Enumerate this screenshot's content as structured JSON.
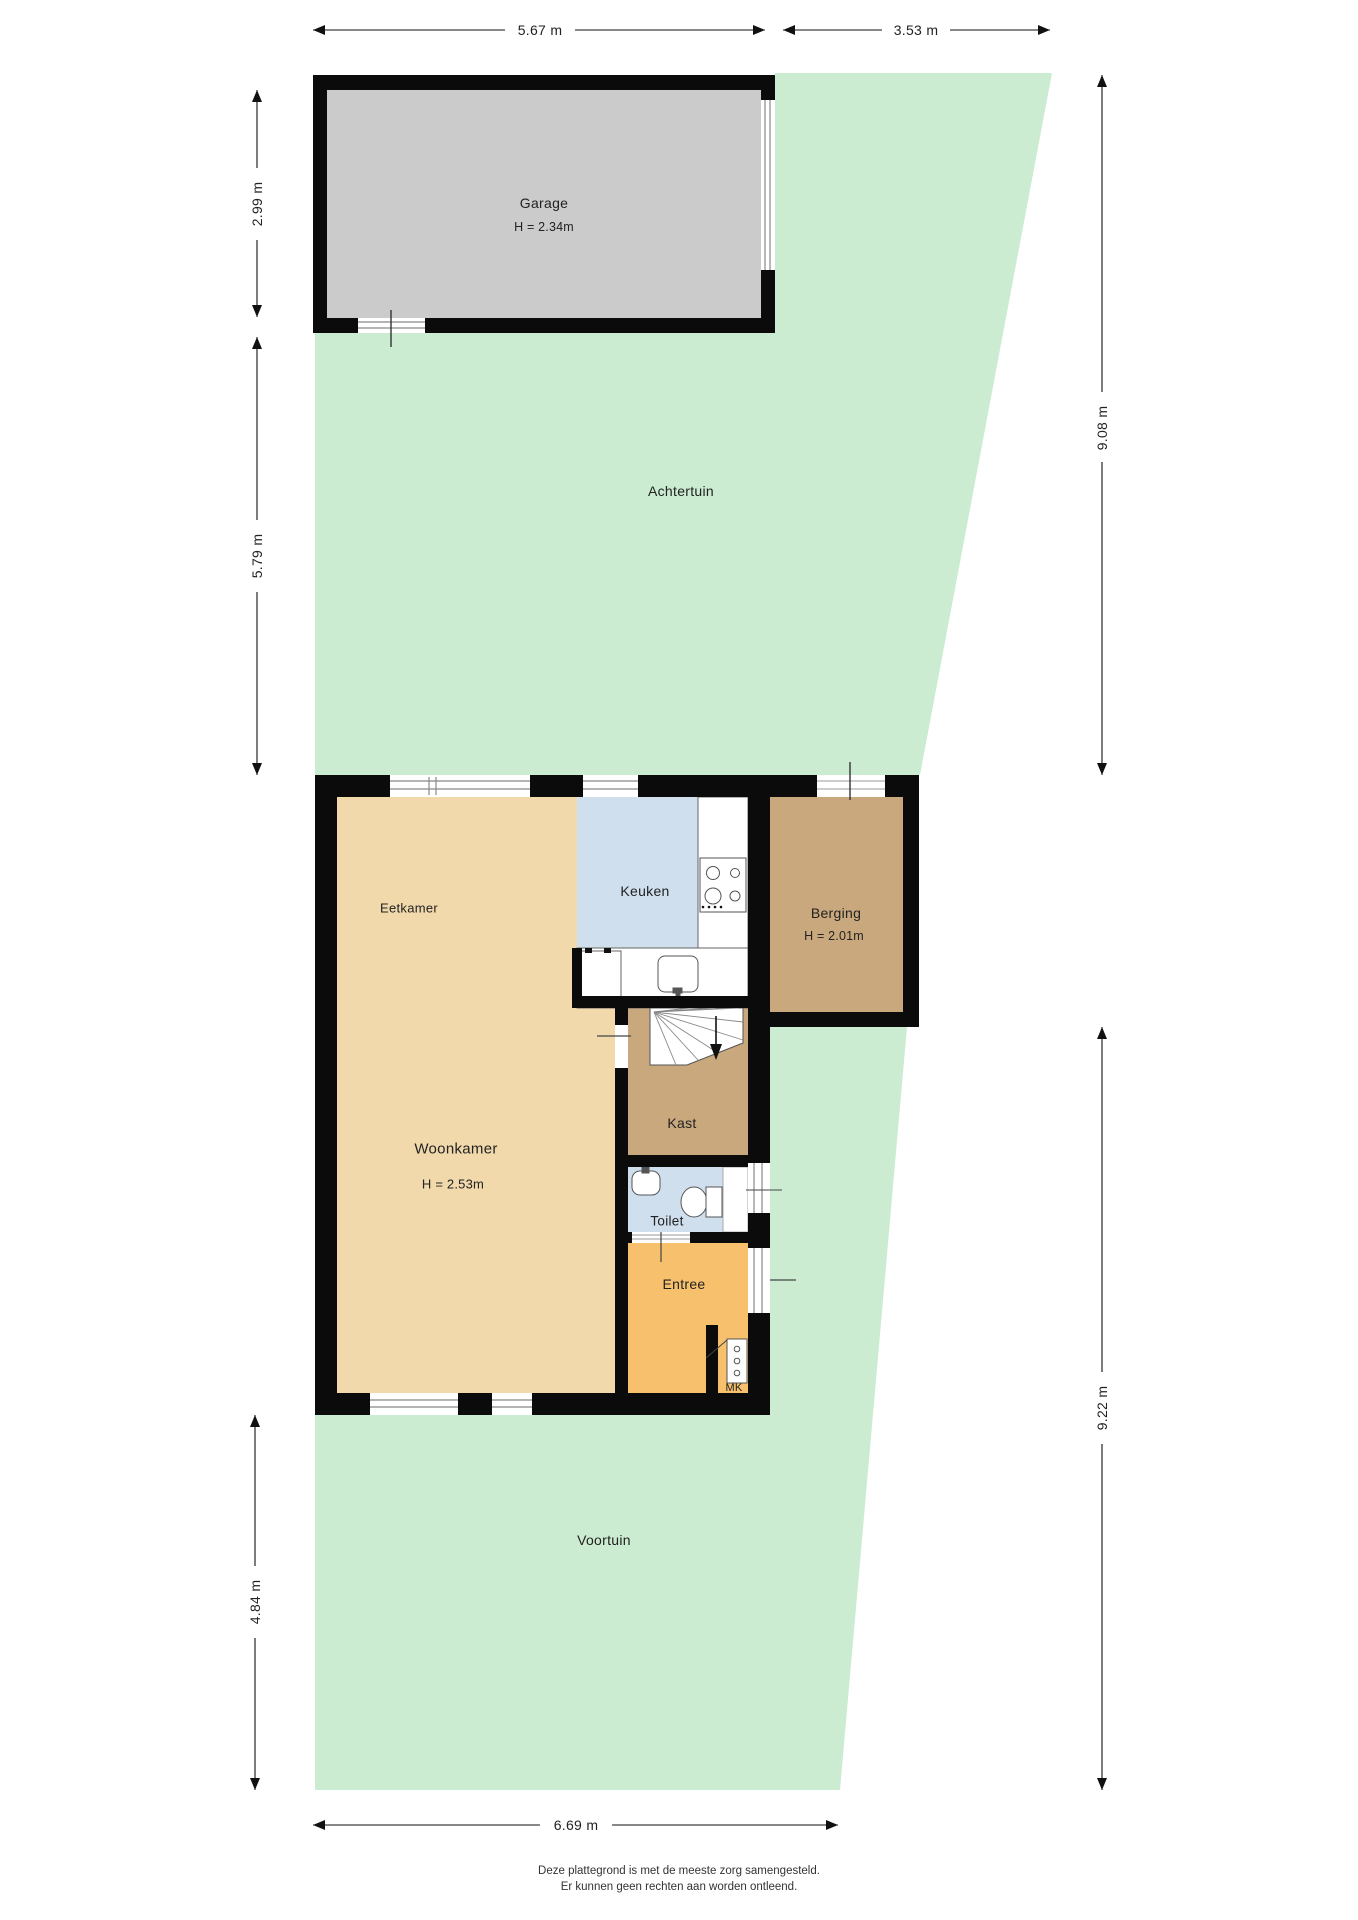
{
  "dimensions": {
    "garage_width": "5.67 m",
    "back_plot_width": "3.53 m",
    "garage_depth": "2.99 m",
    "backyard_depth": "5.79 m",
    "backyard_right_depth": "9.08 m",
    "front_right_depth": "9.22 m",
    "frontyard_depth": "4.84 m",
    "frontyard_width": "6.69 m"
  },
  "rooms": {
    "garage": {
      "name": "Garage",
      "ceiling": "H = 2.34m"
    },
    "achtertuin": {
      "name": "Achtertuin"
    },
    "eetkamer": {
      "name": "Eetkamer"
    },
    "keuken": {
      "name": "Keuken"
    },
    "berging": {
      "name": "Berging",
      "ceiling": "H = 2.01m"
    },
    "woonkamer": {
      "name": "Woonkamer",
      "ceiling": "H = 2.53m"
    },
    "kast": {
      "name": "Kast"
    },
    "toilet": {
      "name": "Toilet"
    },
    "entree": {
      "name": "Entree"
    },
    "meterkast": {
      "name": "MK"
    },
    "voortuin": {
      "name": "Voortuin"
    }
  },
  "footer": {
    "line1": "Deze plattegrond is met de meeste zorg samengesteld.",
    "line2": "Er kunnen geen rechten aan worden ontleend."
  },
  "colors": {
    "garden": "#cbecd1",
    "garage_floor": "#cbcbcb",
    "living_floor": "#f2d9ab",
    "kitchen_floor": "#cfdfee",
    "storage_floor": "#c9a87d",
    "entry_floor": "#f6c06c",
    "wall": "#0b0b0b"
  }
}
